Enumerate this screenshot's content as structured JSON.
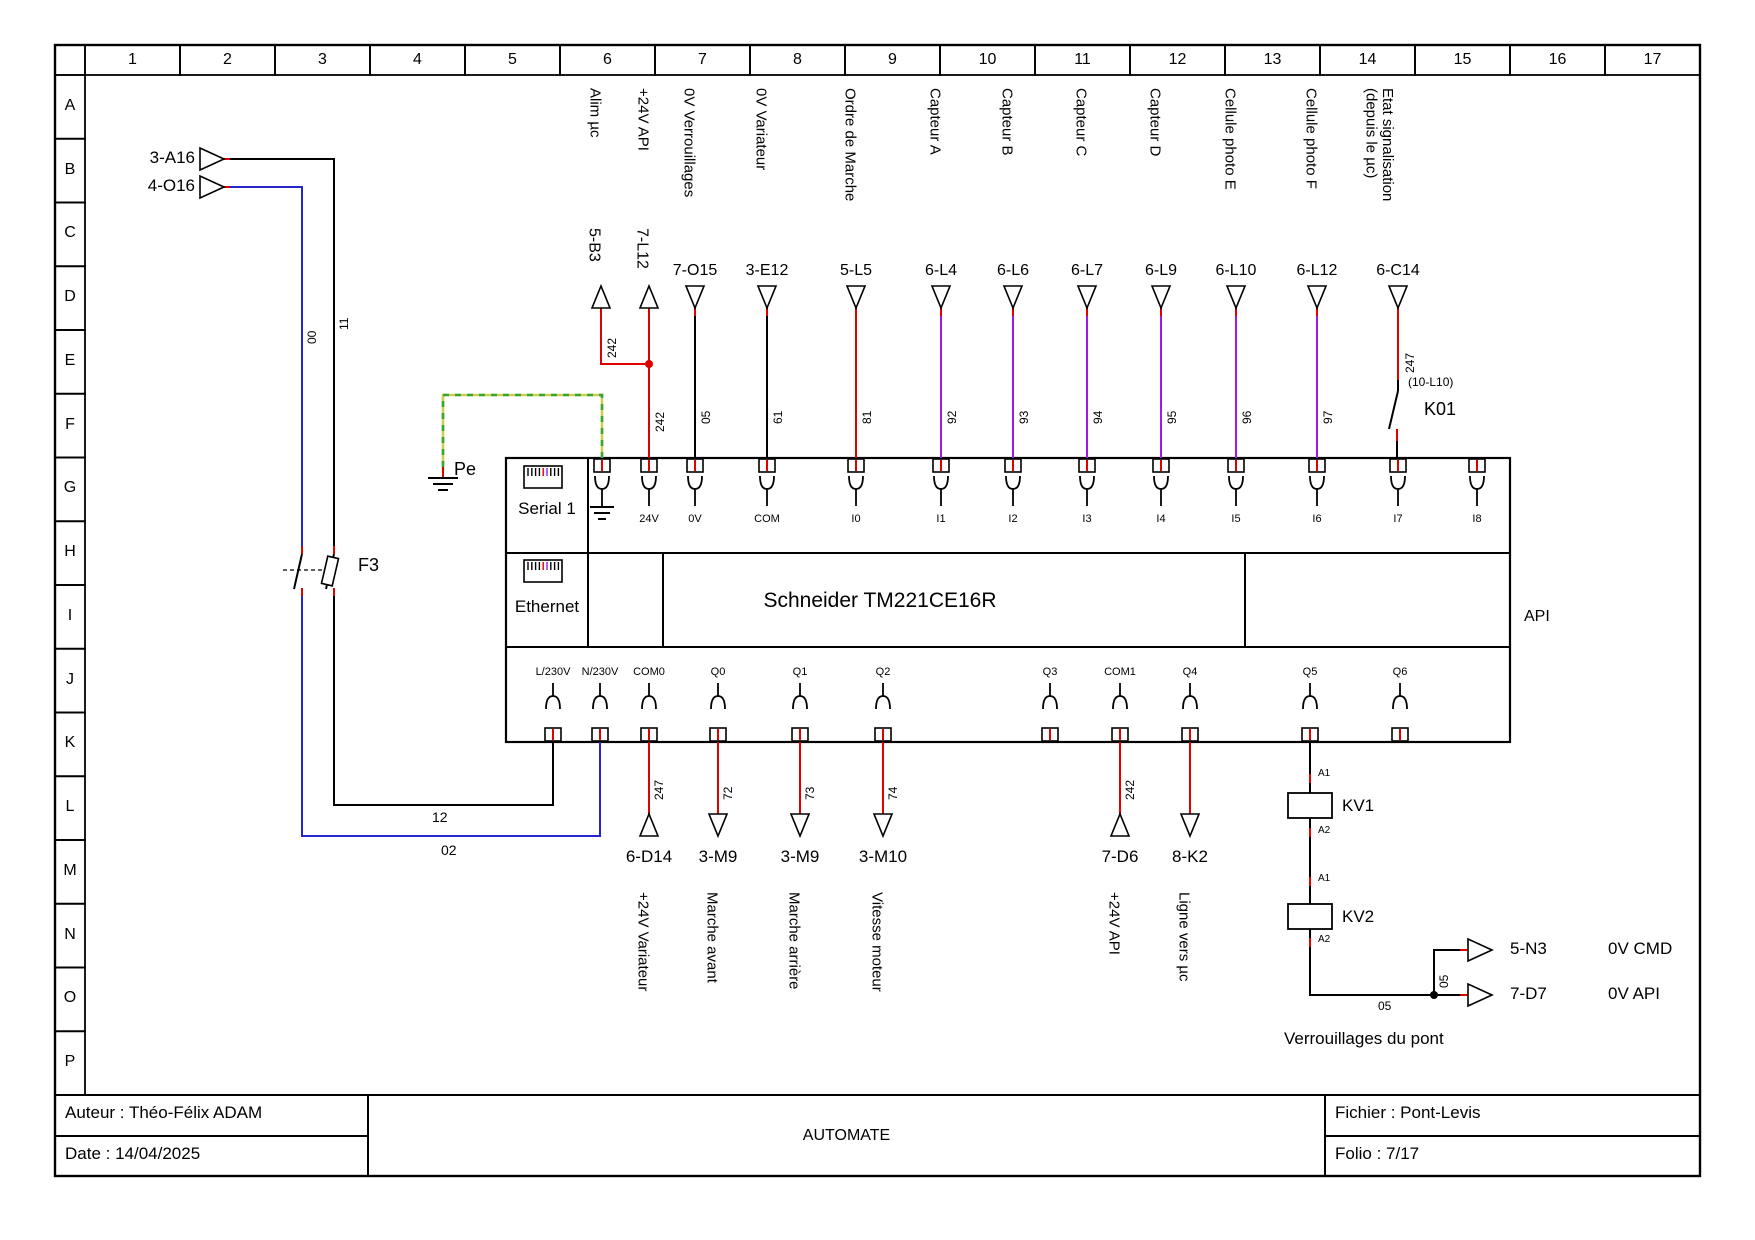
{
  "page": {
    "width": 1755,
    "height": 1240
  },
  "colors": {
    "black": "#000000",
    "red": "#df0000",
    "blue": "#2525d0",
    "purple": "#a21ae6",
    "pe_yellow": "#cfcf4e",
    "pe_green": "#3aa63a",
    "white": "#ffffff"
  },
  "grid": {
    "columns": [
      "1",
      "2",
      "3",
      "4",
      "5",
      "6",
      "7",
      "8",
      "9",
      "10",
      "11",
      "12",
      "13",
      "14",
      "15",
      "16",
      "17"
    ],
    "rows": [
      "A",
      "B",
      "C",
      "D",
      "E",
      "F",
      "G",
      "H",
      "I",
      "J",
      "K",
      "L",
      "M",
      "N",
      "O",
      "P"
    ]
  },
  "plc": {
    "serial_label": "Serial 1",
    "ethernet_label": "Ethernet",
    "title": "Schneider TM221CE16R",
    "api_label": "API",
    "top_terminals": [
      {
        "x": 602,
        "label": "",
        "gnd": true
      },
      {
        "x": 649,
        "label": "24V"
      },
      {
        "x": 695,
        "label": "0V"
      },
      {
        "x": 767,
        "label": "COM"
      },
      {
        "x": 856,
        "label": "I0"
      },
      {
        "x": 941,
        "label": "I1"
      },
      {
        "x": 1013,
        "label": "I2"
      },
      {
        "x": 1087,
        "label": "I3"
      },
      {
        "x": 1161,
        "label": "I4"
      },
      {
        "x": 1236,
        "label": "I5"
      },
      {
        "x": 1317,
        "label": "I6"
      },
      {
        "x": 1398,
        "label": "I7"
      },
      {
        "x": 1477,
        "label": "I8"
      }
    ],
    "bottom_terminals": [
      {
        "x": 553,
        "label": "L/230V"
      },
      {
        "x": 600,
        "label": "N/230V"
      },
      {
        "x": 649,
        "label": "COM0"
      },
      {
        "x": 718,
        "label": "Q0"
      },
      {
        "x": 800,
        "label": "Q1"
      },
      {
        "x": 883,
        "label": "Q2"
      },
      {
        "x": 1050,
        "label": "Q3"
      },
      {
        "x": 1120,
        "label": "COM1"
      },
      {
        "x": 1190,
        "label": "Q4"
      },
      {
        "x": 1310,
        "label": "Q5"
      },
      {
        "x": 1400,
        "label": "Q6"
      }
    ]
  },
  "top_circuits": [
    {
      "x": 601,
      "label": "Alim µc",
      "ref": "5-B3",
      "refv": true,
      "arrow": "up",
      "color": "red",
      "num": "242",
      "numx": 606,
      "numy": 358,
      "type": "source"
    },
    {
      "x": 649,
      "label": "+24V API",
      "ref": "7-L12",
      "refv": true,
      "arrow": "up",
      "color": "red",
      "num": "242",
      "numx": 654,
      "numy": 432
    },
    {
      "x": 695,
      "label": "0V Verrouillages",
      "ref": "7-O15",
      "refv": false,
      "arrow": "down",
      "color": "black",
      "num": "05",
      "numx": 700,
      "numy": 424
    },
    {
      "x": 767,
      "label": "0V Variateur",
      "ref": "3-E12",
      "refv": false,
      "arrow": "down",
      "color": "black",
      "num": "61",
      "numx": 772,
      "numy": 424
    },
    {
      "x": 856,
      "label": "Ordre de Marche",
      "ref": "5-L5",
      "refv": false,
      "arrow": "down",
      "color": "red",
      "num": "81",
      "numx": 861,
      "numy": 424
    },
    {
      "x": 941,
      "label": "Capteur A",
      "ref": "6-L4",
      "refv": false,
      "arrow": "down",
      "color": "purple",
      "num": "92",
      "numx": 946,
      "numy": 424
    },
    {
      "x": 1013,
      "label": "Capteur B",
      "ref": "6-L6",
      "refv": false,
      "arrow": "down",
      "color": "purple",
      "num": "93",
      "numx": 1018,
      "numy": 424
    },
    {
      "x": 1087,
      "label": "Capteur C",
      "ref": "6-L7",
      "refv": false,
      "arrow": "down",
      "color": "purple",
      "num": "94",
      "numx": 1092,
      "numy": 424
    },
    {
      "x": 1161,
      "label": "Capteur D",
      "ref": "6-L9",
      "refv": false,
      "arrow": "down",
      "color": "purple",
      "num": "95",
      "numx": 1166,
      "numy": 424
    },
    {
      "x": 1236,
      "label": "Cellule photo E",
      "ref": "6-L10",
      "refv": false,
      "arrow": "down",
      "color": "purple",
      "num": "96",
      "numx": 1241,
      "numy": 424
    },
    {
      "x": 1317,
      "label": "Cellule photo F",
      "ref": "6-L12",
      "refv": false,
      "arrow": "down",
      "color": "purple",
      "num": "97",
      "numx": 1322,
      "numy": 424
    },
    {
      "x": 1398,
      "label": "Etat signalisation\n(depuis le µc)",
      "ref": "6-C14",
      "refv": false,
      "arrow": "down",
      "color": "red",
      "type": "k01"
    }
  ],
  "bottom_circuits": [
    {
      "x": 649,
      "ref": "6-D14",
      "arrow": "up",
      "num": "247",
      "vlabel": "+24V Variateur"
    },
    {
      "x": 718,
      "ref": "3-M9",
      "arrow": "down",
      "num": "72",
      "vlabel": "Marche avant"
    },
    {
      "x": 800,
      "ref": "3-M9",
      "arrow": "down",
      "num": "73",
      "vlabel": "Marche arrière"
    },
    {
      "x": 883,
      "ref": "3-M10",
      "arrow": "down",
      "num": "74",
      "vlabel": "Vitesse moteur"
    },
    {
      "x": 1120,
      "ref": "7-D6",
      "arrow": "up",
      "num": "242",
      "vlabel": "+24V API"
    },
    {
      "x": 1190,
      "ref": "8-K2",
      "arrow": "down",
      "num": "",
      "vlabel": "Ligne vers µc"
    }
  ],
  "left_feed": {
    "ref_top": "3-A16",
    "ref_bottom": "4-O16",
    "num_00": "00",
    "num_11": "11",
    "num_12": "12",
    "num_02": "02",
    "breaker": "F3"
  },
  "pe": {
    "label": "Pe"
  },
  "k01": {
    "label": "K01",
    "num": "247",
    "note": "(10-L10)"
  },
  "kv": {
    "kv1": "KV1",
    "kv2": "KV2",
    "a1": "A1",
    "a2": "A2",
    "num_h": "05",
    "num_v": "05",
    "out_top_ref": "5-N3",
    "out_top_label": "0V CMD",
    "out_bottom_ref": "7-D7",
    "out_bottom_label": "0V API",
    "caption": "Verrouillages du pont"
  },
  "title_block": {
    "author": "Auteur : Théo-Félix ADAM",
    "date": "Date : 14/04/2025",
    "center": "AUTOMATE",
    "file": "Fichier : Pont-Levis",
    "folio": "Folio : 7/17"
  },
  "extra_wires": [
    {
      "c": "red",
      "pts": [
        [
          222,
          159
        ],
        [
          231,
          159
        ]
      ]
    },
    {
      "c": "black",
      "pts": [
        [
          230,
          159
        ],
        [
          334,
          159
        ],
        [
          334,
          547
        ]
      ]
    },
    {
      "c": "red",
      "pts": [
        [
          334,
          546
        ],
        [
          334,
          554
        ]
      ]
    },
    {
      "c": "black",
      "pts": [
        [
          334,
          554
        ],
        [
          326,
          589
        ]
      ]
    },
    {
      "c": "red",
      "pts": [
        [
          334,
          588
        ],
        [
          334,
          596
        ]
      ]
    },
    {
      "c": "black",
      "pts": [
        [
          334,
          596
        ],
        [
          334,
          805
        ],
        [
          553,
          805
        ],
        [
          553,
          742
        ]
      ]
    },
    {
      "c": "red",
      "pts": [
        [
          222,
          187
        ],
        [
          231,
          187
        ]
      ]
    },
    {
      "c": "blue",
      "pts": [
        [
          230,
          187
        ],
        [
          302,
          187
        ],
        [
          302,
          547
        ]
      ]
    },
    {
      "c": "red",
      "pts": [
        [
          302,
          546
        ],
        [
          302,
          554
        ]
      ]
    },
    {
      "c": "black",
      "pts": [
        [
          302,
          554
        ],
        [
          294,
          589
        ]
      ]
    },
    {
      "c": "red",
      "pts": [
        [
          302,
          588
        ],
        [
          302,
          596
        ]
      ]
    },
    {
      "c": "blue",
      "pts": [
        [
          302,
          596
        ],
        [
          302,
          836
        ],
        [
          600,
          836
        ],
        [
          600,
          742
        ]
      ]
    },
    {
      "c": "black",
      "w": 1.2,
      "dash": [
        4,
        3
      ],
      "pts": [
        [
          283,
          570
        ],
        [
          326,
          570
        ]
      ]
    },
    {
      "c": "pe_yellow",
      "w": 2.6,
      "pts": [
        [
          602,
          458
        ],
        [
          602,
          395
        ],
        [
          443,
          395
        ],
        [
          443,
          471
        ]
      ]
    },
    {
      "c": "pe_green",
      "w": 2.6,
      "dash": [
        6,
        6
      ],
      "pts": [
        [
          602,
          458
        ],
        [
          602,
          395
        ],
        [
          443,
          395
        ],
        [
          443,
          471
        ]
      ]
    },
    {
      "c": "red",
      "pts": [
        [
          443,
          467
        ],
        [
          443,
          477
        ]
      ]
    },
    {
      "c": "black",
      "pts": [
        [
          428,
          478
        ],
        [
          458,
          478
        ]
      ]
    },
    {
      "c": "black",
      "pts": [
        [
          433,
          484
        ],
        [
          453,
          484
        ]
      ]
    },
    {
      "c": "black",
      "pts": [
        [
          438,
          490
        ],
        [
          448,
          490
        ]
      ]
    },
    {
      "c": "red",
      "pts": [
        [
          1398,
          316
        ],
        [
          1398,
          380
        ]
      ]
    },
    {
      "c": "black",
      "pts": [
        [
          1398,
          380
        ],
        [
          1398,
          391
        ]
      ]
    },
    {
      "c": "black",
      "pts": [
        [
          1398,
          391
        ],
        [
          1389,
          429
        ]
      ]
    },
    {
      "c": "red",
      "pts": [
        [
          1397,
          429
        ],
        [
          1397,
          441
        ]
      ]
    },
    {
      "c": "black",
      "pts": [
        [
          1397,
          441
        ],
        [
          1397,
          458
        ]
      ]
    },
    {
      "c": "black",
      "pts": [
        [
          1310,
          742
        ],
        [
          1310,
          776
        ]
      ]
    },
    {
      "c": "red",
      "pts": [
        [
          1310,
          774
        ],
        [
          1310,
          783
        ]
      ]
    },
    {
      "c": "black",
      "pts": [
        [
          1310,
          783
        ],
        [
          1310,
          793
        ]
      ]
    },
    {
      "c": "black",
      "pts": [
        [
          1310,
          818
        ],
        [
          1310,
          830
        ]
      ]
    },
    {
      "c": "red",
      "pts": [
        [
          1310,
          828
        ],
        [
          1310,
          837
        ]
      ]
    },
    {
      "c": "black",
      "pts": [
        [
          1310,
          837
        ],
        [
          1310,
          879
        ]
      ]
    },
    {
      "c": "red",
      "pts": [
        [
          1310,
          877
        ],
        [
          1310,
          886
        ]
      ]
    },
    {
      "c": "black",
      "pts": [
        [
          1310,
          886
        ],
        [
          1310,
          904
        ]
      ]
    },
    {
      "c": "black",
      "pts": [
        [
          1310,
          929
        ],
        [
          1310,
          940
        ]
      ]
    },
    {
      "c": "red",
      "pts": [
        [
          1310,
          938
        ],
        [
          1310,
          947
        ]
      ]
    },
    {
      "c": "black",
      "pts": [
        [
          1310,
          947
        ],
        [
          1310,
          995
        ],
        [
          1434,
          995
        ]
      ]
    },
    {
      "c": "black",
      "pts": [
        [
          1434,
          995
        ],
        [
          1461,
          995
        ]
      ]
    },
    {
      "c": "red",
      "pts": [
        [
          1460,
          995
        ],
        [
          1468,
          995
        ]
      ]
    },
    {
      "c": "black",
      "pts": [
        [
          1434,
          995
        ],
        [
          1434,
          950
        ],
        [
          1461,
          950
        ]
      ]
    },
    {
      "c": "red",
      "pts": [
        [
          1460,
          950
        ],
        [
          1468,
          950
        ]
      ]
    }
  ],
  "junctions": [
    {
      "x": 649,
      "y": 364,
      "c": "red"
    },
    {
      "x": 1434,
      "y": 995,
      "c": "black"
    }
  ]
}
